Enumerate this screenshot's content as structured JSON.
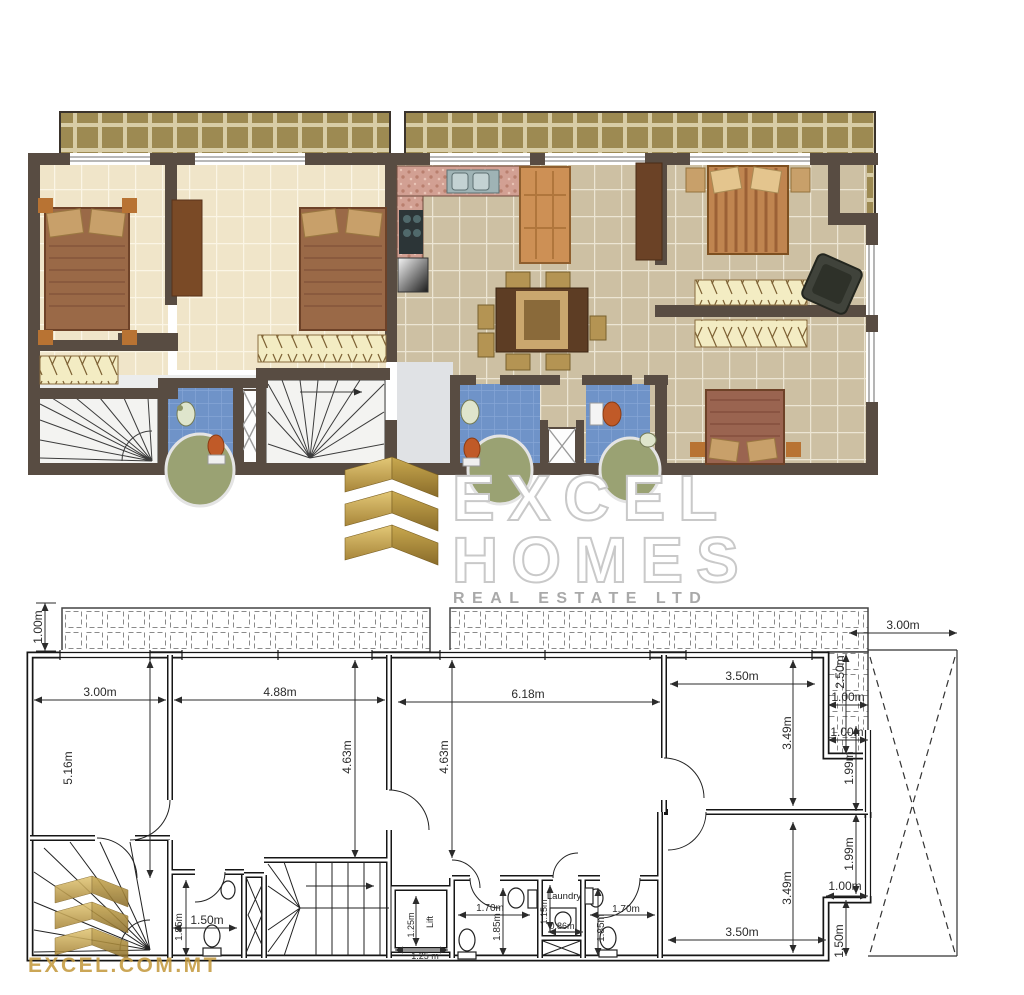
{
  "logo": {
    "word1": "EXCEL",
    "word2": "HOMES",
    "tagline": "REAL ESTATE LTD"
  },
  "watermark": {
    "site": "EXCEL.COM.MT"
  },
  "colors": {
    "terrace_tile": "#a6905a",
    "wall": "#584c42",
    "bedroom_floor": "#f0e5c9",
    "living_floor": "#cdc0a3",
    "bath_tile": "#6f93c8",
    "stair_floor": "#f3f3f1",
    "kitchen_counter": "#d2a093",
    "logo_gold": "#c2a14d",
    "plan_line": "#1f1f1f",
    "tub_green": "#9aa273",
    "toilet_orange": "#c05a28"
  },
  "bottom_plan": {
    "room_labels": {
      "laundry": "Laundry",
      "lift": "Lift"
    },
    "dims": {
      "d100_tl": "1.00m",
      "d300_left": "3.00m",
      "d488": "4.88m",
      "d618": "6.18m",
      "d350_top": "3.50m",
      "d250": "2.50m",
      "d100_terr": "1.00m",
      "d300_yard": "3.00m",
      "d100_step_top": "1.00m",
      "d349_top": "3.49m",
      "d199_top": "1.99m",
      "d516": "5.16m",
      "d463_a": "4.63m",
      "d463_b": "4.63m",
      "d349_bot": "3.49m",
      "d199_bot": "1.99m",
      "d100_step_bot": "1.00m",
      "d350_bot": "3.50m",
      "d150_step": "1.50m",
      "d185_wc_left": "1.85m",
      "d150_wc_left": "1.50m",
      "d170_wc1": "1.70m",
      "d185_wc1": "1.85m",
      "d115_laundry": "1.15m",
      "d086_laundry": "0.86m",
      "d170_wc2": "1.70m",
      "d185_wc2": "1.85m",
      "d125_lift_v": "1.25m",
      "d125_lift_h": "1.25 m"
    }
  }
}
